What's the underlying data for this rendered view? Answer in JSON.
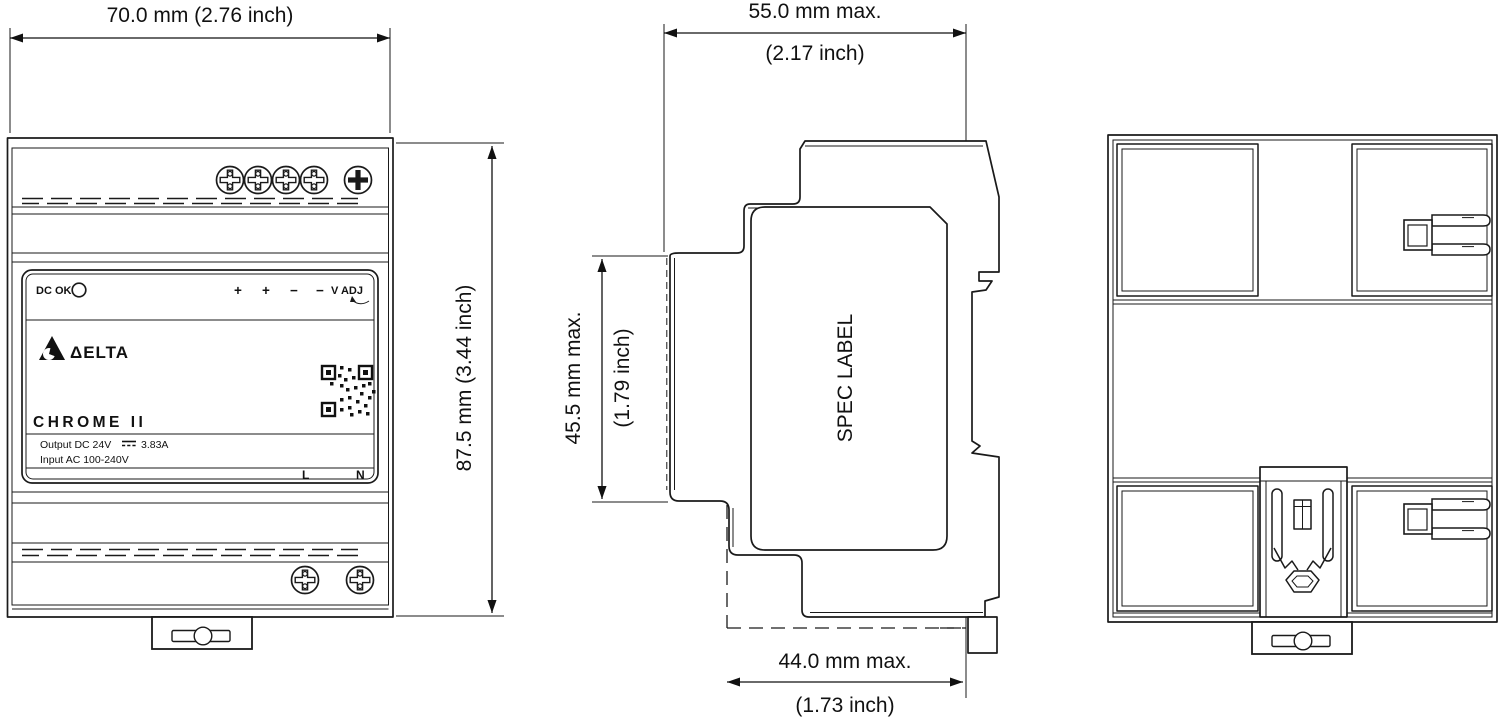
{
  "front_view": {
    "dc_ok_label": "DC OK",
    "terminal_labels": [
      "+",
      "+",
      "−",
      "−"
    ],
    "v_adj_label": "V ADJ",
    "brand": "ΔELTA",
    "series": "CHROME II",
    "output_label": "Output DC 24V",
    "output_current": "3.83A",
    "input_label": "Input AC 100-240V",
    "line_label": "L",
    "neutral_label": "N"
  },
  "side_view": {
    "spec_label": "SPEC LABEL"
  },
  "dimensions": {
    "width_mm": "70.0 mm (2.76 inch)",
    "height_mm": "87.5 mm (3.44 inch)",
    "depth_mm": "55.0 mm max.",
    "depth_inch": "(2.17 inch)",
    "body_depth_mm": "45.5 mm max.",
    "body_depth_inch": "(1.79 inch)",
    "rear_depth_mm": "44.0 mm max.",
    "rear_depth_inch": "(1.73 inch)"
  },
  "colors": {
    "line": "#1a1a1a",
    "background": "#ffffff"
  }
}
